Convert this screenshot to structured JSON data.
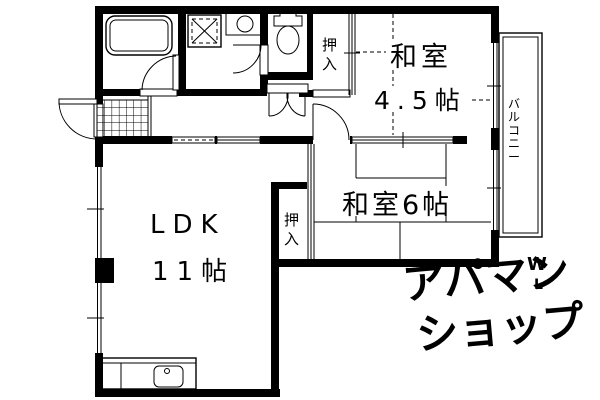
{
  "colors": {
    "ink": "#000000",
    "paper": "#ffffff",
    "watermark": "#ebebeb"
  },
  "rooms": {
    "washitsu45": {
      "name": "和室",
      "size": "4.5帖"
    },
    "washitsu6": {
      "name": "和室6帖"
    },
    "ldk": {
      "name": "LDK",
      "size": "11帖"
    },
    "balcony": {
      "name": "バルコニー"
    },
    "closet_upper": {
      "name": "押入"
    },
    "closet_middle": {
      "name": "押入"
    }
  },
  "watermark": {
    "line1": "アパマン",
    "line2": "ショップ",
    "mark_top": "W",
    "mark_bottom": "L"
  }
}
